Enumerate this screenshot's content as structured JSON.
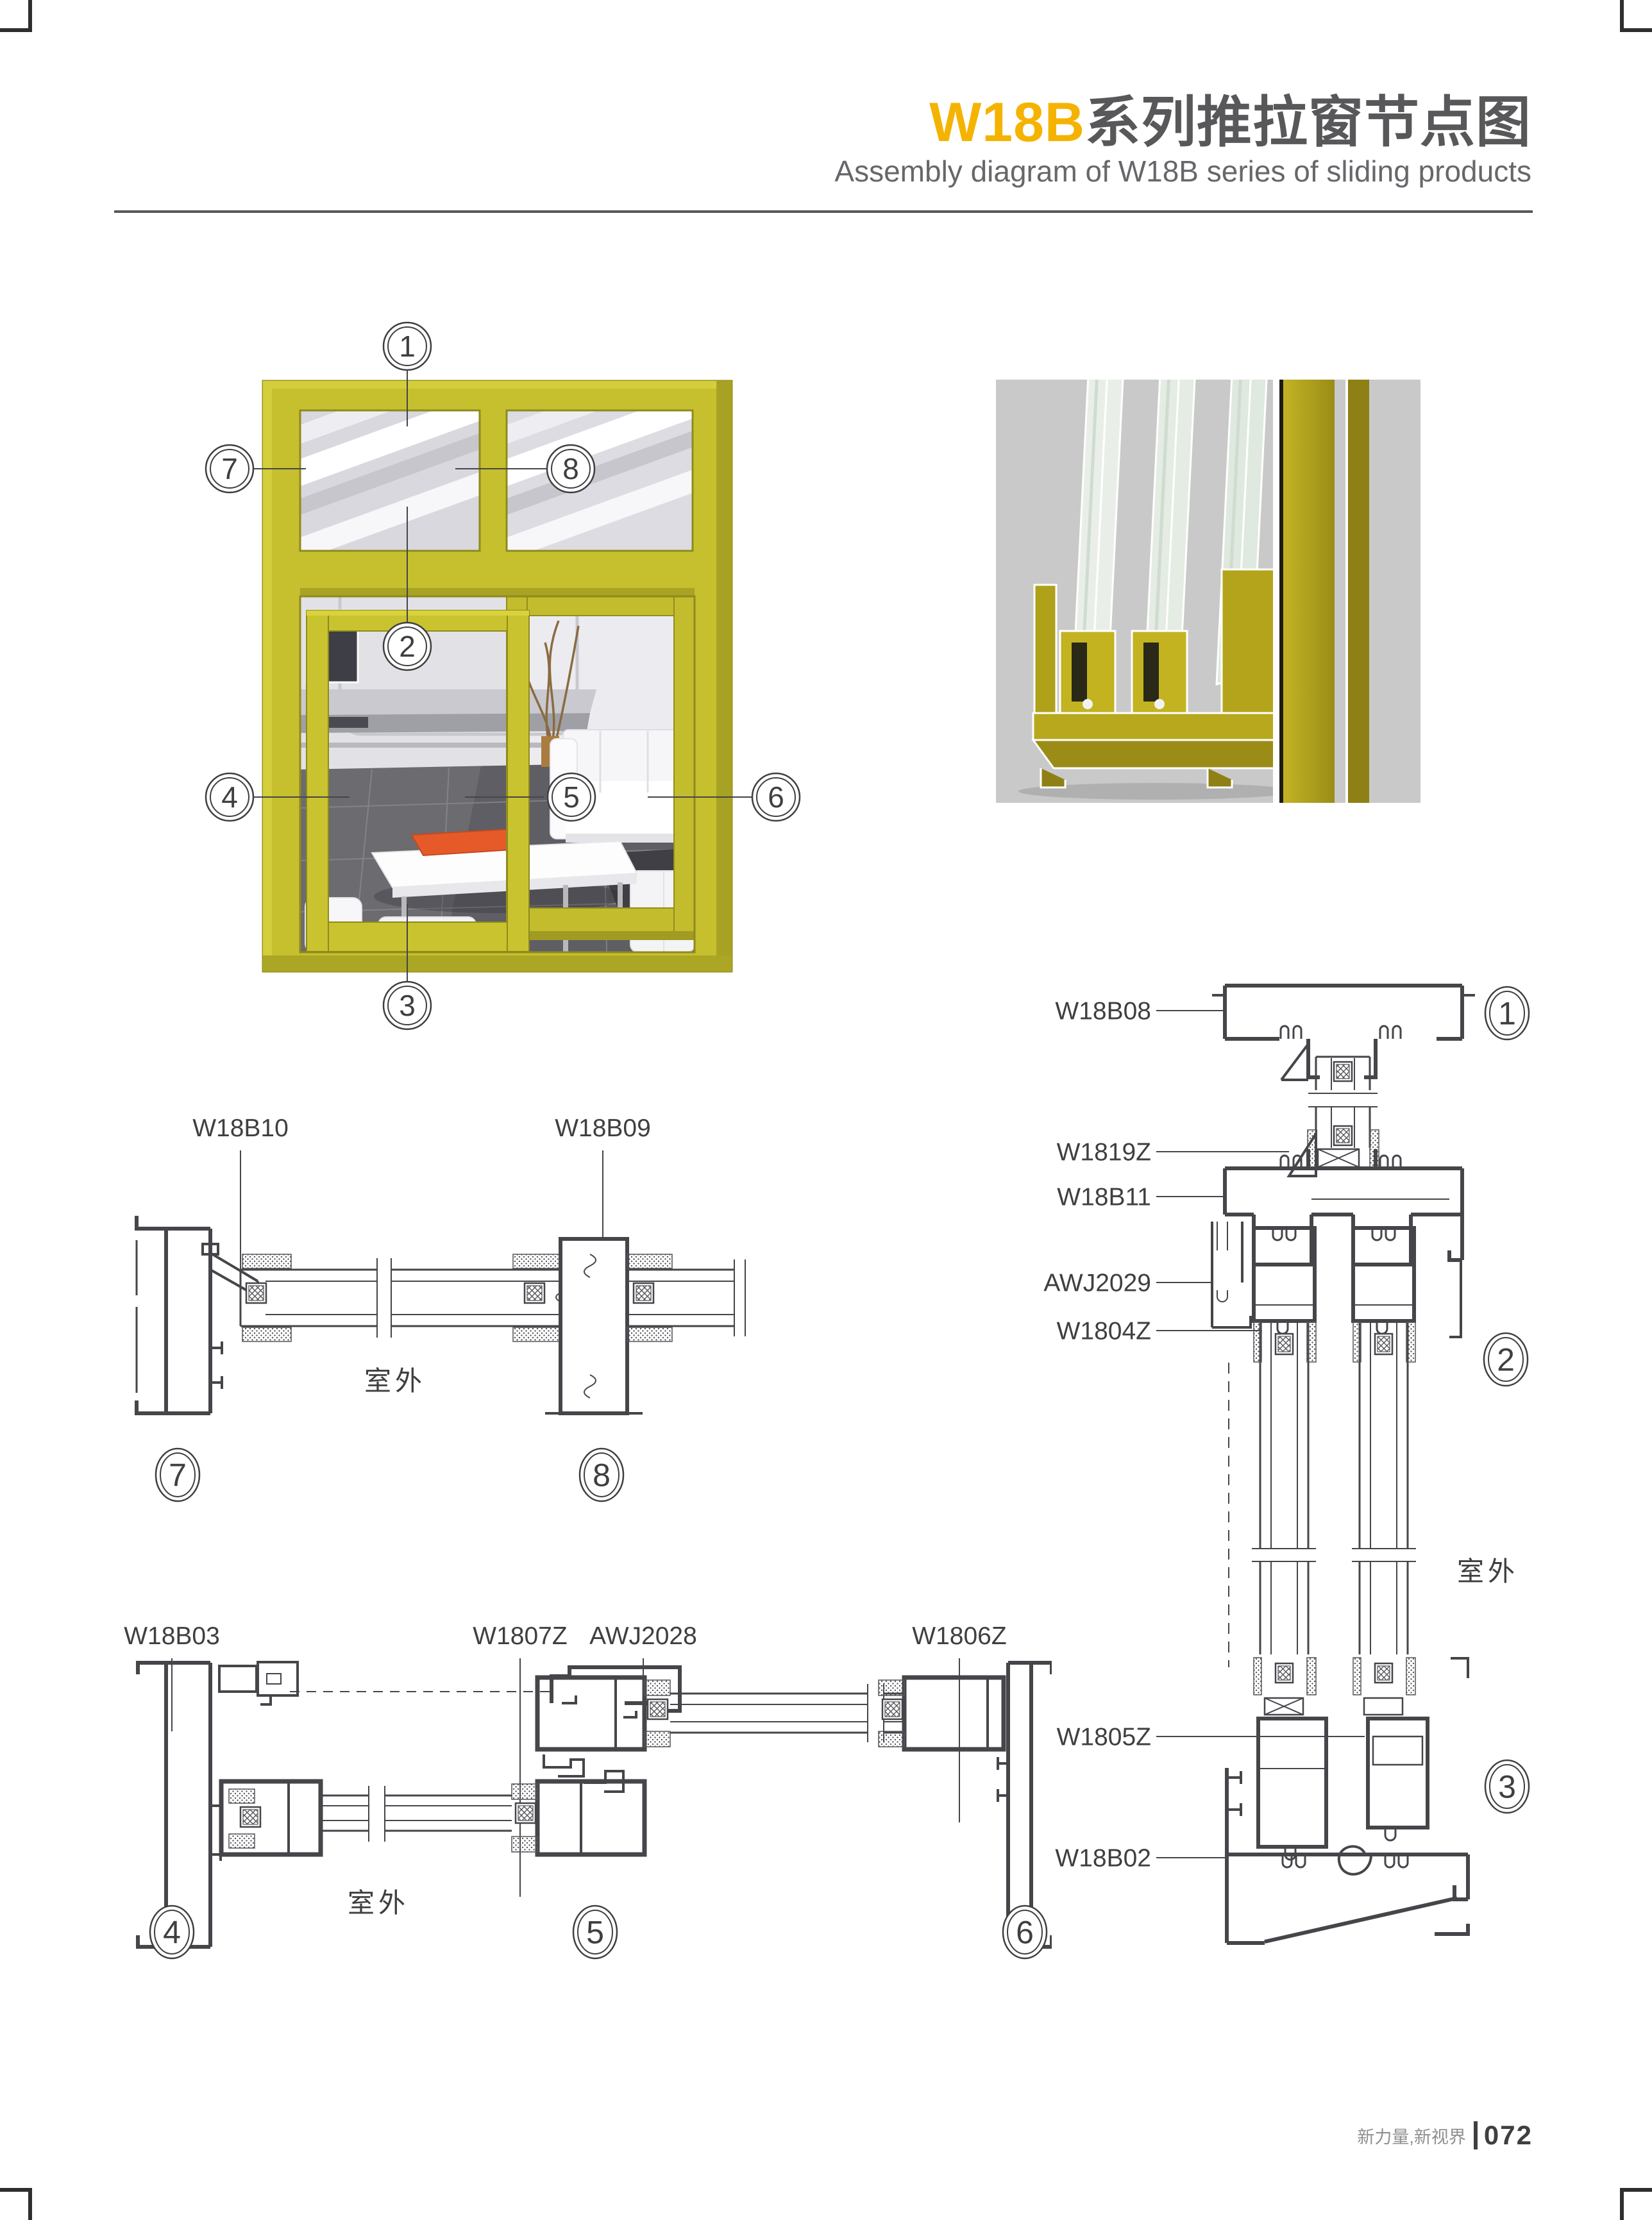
{
  "header": {
    "title_accent": "W18B",
    "title_rest": "系列推拉窗节点图",
    "subtitle": "Assembly diagram of W18B series of sliding products"
  },
  "overview": {
    "callouts": [
      "1",
      "2",
      "3",
      "4",
      "5",
      "6",
      "7",
      "8"
    ]
  },
  "sections": {
    "head_jamb": {
      "labels": [
        "W18B10",
        "W18B09"
      ],
      "outdoor": "室外",
      "callouts": [
        "7",
        "8"
      ]
    },
    "vertical": {
      "labels": [
        "W18B08",
        "W1819Z",
        "W18B11",
        "AWJ2029",
        "W1804Z",
        "W1805Z",
        "W18B02"
      ],
      "outdoor": "室外",
      "callouts": [
        "1",
        "2",
        "3"
      ]
    },
    "horizontal": {
      "labels": [
        "W18B03",
        "W1807Z",
        "AWJ2028",
        "W1806Z"
      ],
      "outdoor": "室外",
      "callouts": [
        "4",
        "5",
        "6"
      ]
    }
  },
  "footer": {
    "slogan": "新力量,新视界",
    "page_number": "072"
  },
  "colors": {
    "title_accent": "#F5B301",
    "title_gray": "#58585A",
    "frame_yellow": "#C6C02F",
    "drawing_line": "#45454A",
    "render_background": "#C9C9CA",
    "orange_tray": "#E65A2A"
  }
}
